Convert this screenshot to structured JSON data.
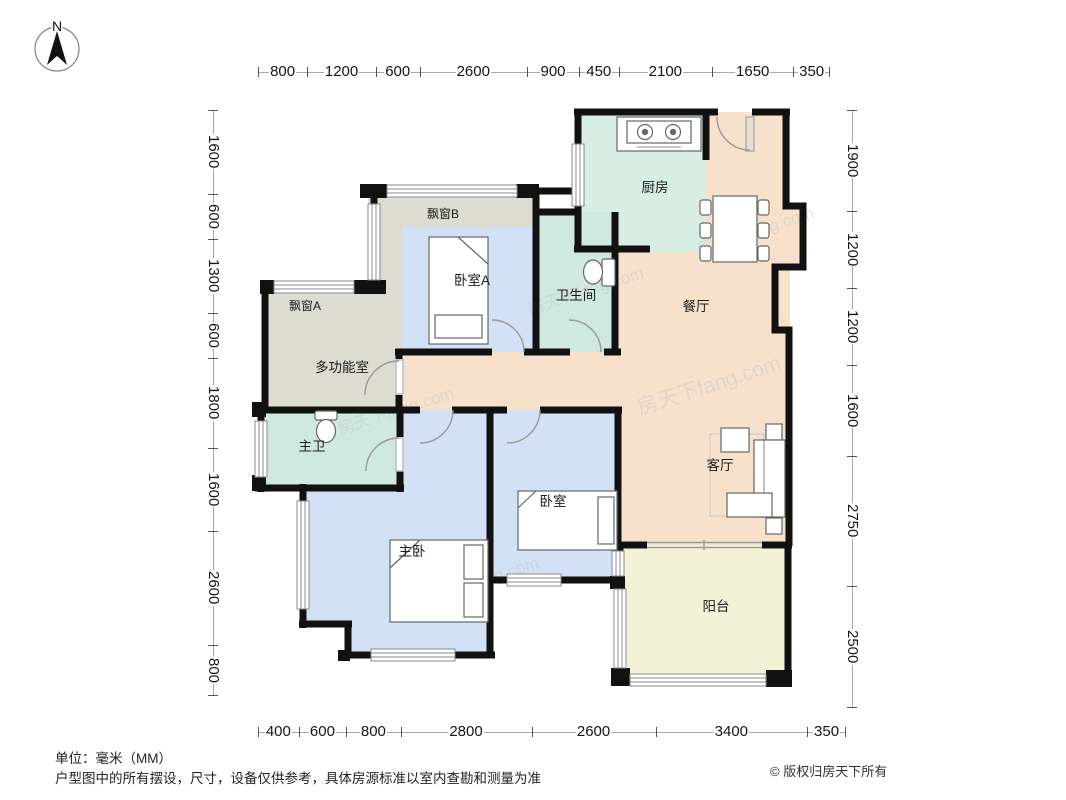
{
  "compass": {
    "north_label": "N"
  },
  "watermark": {
    "text": "房天下fang.com"
  },
  "rooms": {
    "kitchen": "厨房",
    "dining": "餐厅",
    "living": "客厅",
    "balcony": "阳台",
    "bathroom": "卫生间",
    "bedroom_a": "卧室A",
    "bedroom": "卧室",
    "master_bedroom": "主卧",
    "multi_room": "多功能室",
    "master_bath": "主卫",
    "bay_window_a": "飘窗A",
    "bay_window_b": "飘窗B"
  },
  "dimensions": {
    "top": [
      "800",
      "1200",
      "600",
      "2600",
      "900",
      "450",
      "2100",
      "1650",
      "350"
    ],
    "left": [
      "1600",
      "600",
      "1300",
      "600",
      "1800",
      "1600",
      "2600",
      "800"
    ],
    "right": [
      "1900",
      "1200",
      "1200",
      "1600",
      "2750",
      "2500"
    ],
    "bottom": [
      "400",
      "600",
      "800",
      "2800",
      "2600",
      "3400",
      "350"
    ]
  },
  "footer": {
    "unit": "单位：毫米（MM）",
    "disclaimer": "户型图中的所有摆设，尺寸，设备仅供参考，具体房源标准以室内查勘和测量为准",
    "copyright": "© 版权归房天下所有"
  },
  "colors": {
    "wall": "#111111",
    "room_peach": "#f7e1cb",
    "room_teal": "#d4ebe2",
    "room_blue": "#d3e1f6",
    "room_grey": "#dcddd0",
    "room_cream": "#f5f1d7"
  }
}
